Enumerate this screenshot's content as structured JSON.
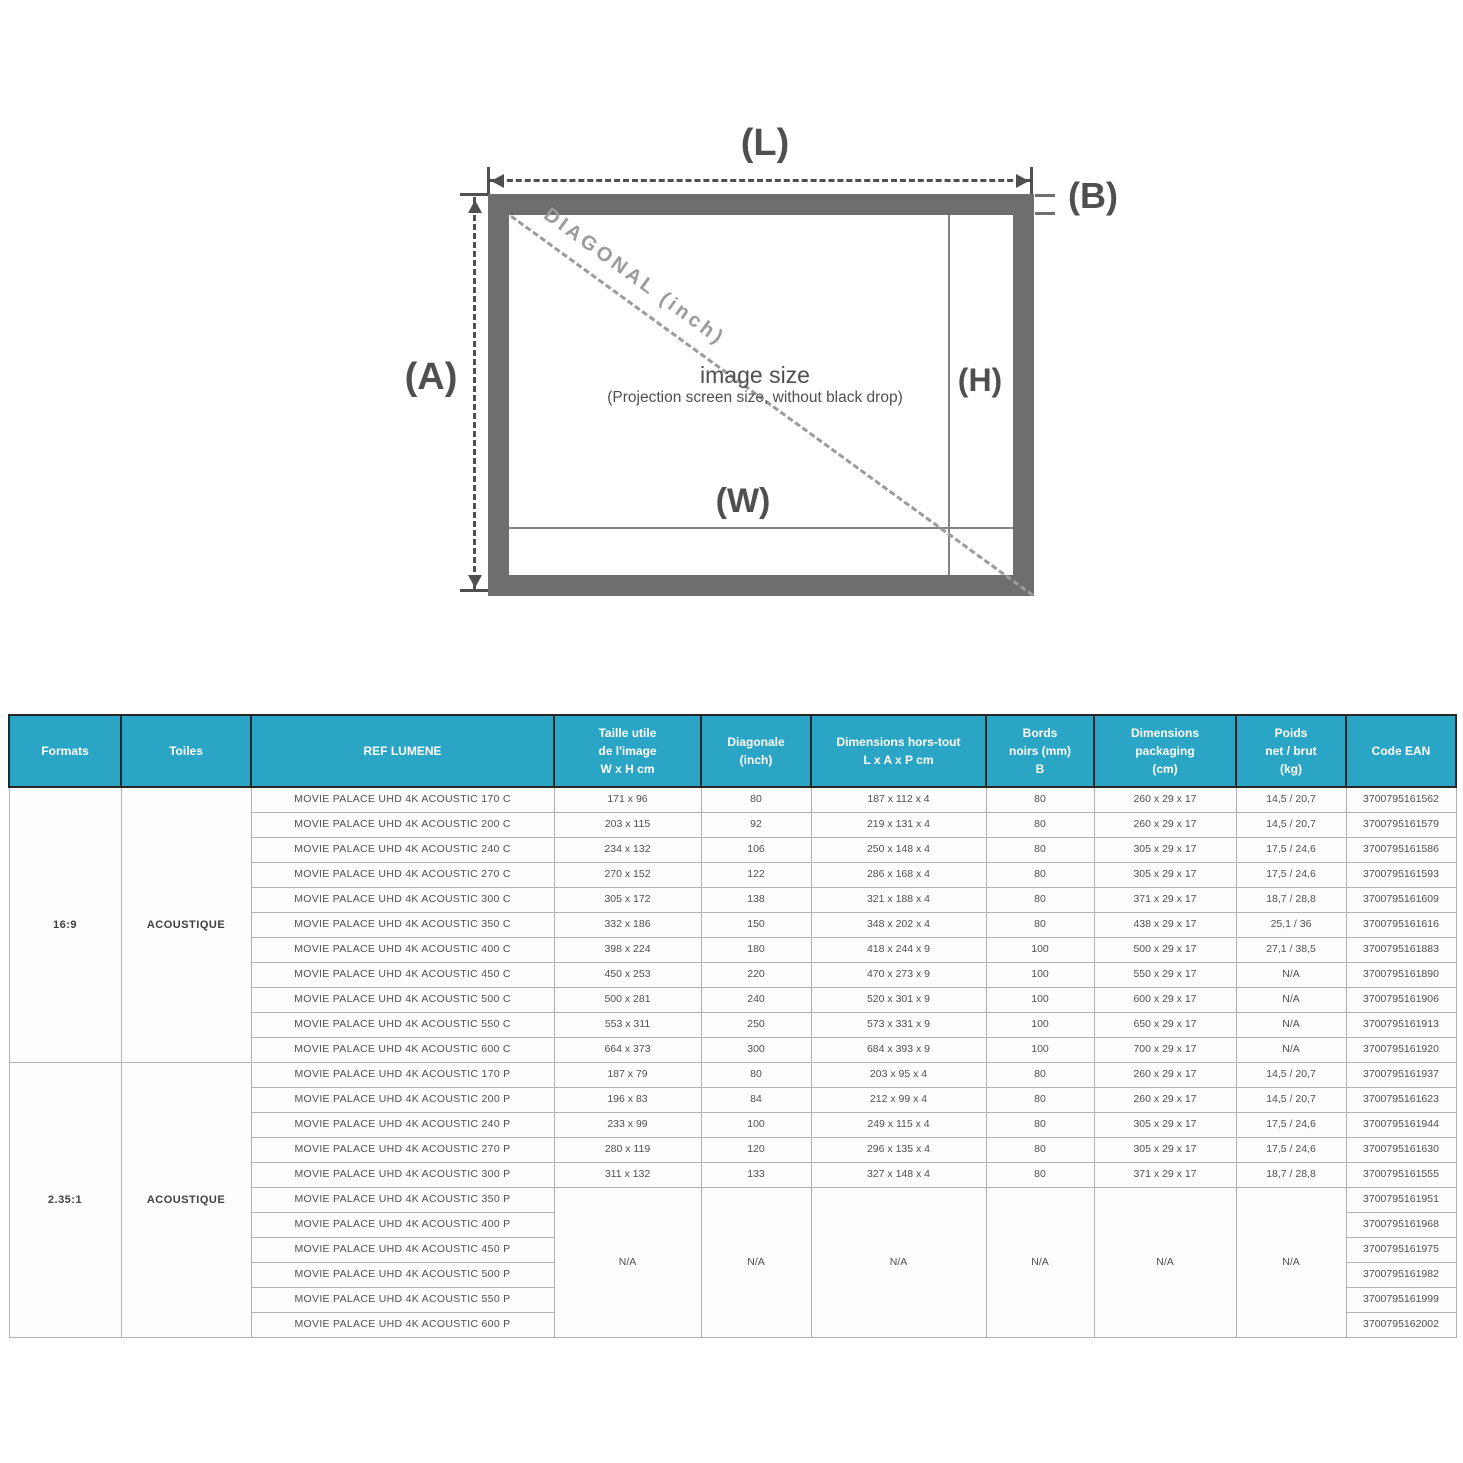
{
  "colors": {
    "accent_teal": "#2aa5c6",
    "frame_gray": "#6e6e6e",
    "dim_line": "#4f4f4f",
    "diagonal_gray": "#9b9b9b"
  },
  "diagram": {
    "label_L": "(L)",
    "label_B": "(B)",
    "label_A": "(A)",
    "label_H": "(H)",
    "label_W": "(W)",
    "diagonal_label": "DIAGONAL (inch)",
    "image_size_title": "image size",
    "image_size_subtitle": "(Projection screen size, without black drop)"
  },
  "table": {
    "headers": [
      "Formats",
      "Toiles",
      "REF LUMENE",
      "Taille utile\nde l'image\nW x H cm",
      "Diagonale\n(inch)",
      "Dimensions hors-tout\nL x A x P cm",
      "Bords\nnoirs (mm)\nB",
      "Dimensions\npackaging\n(cm)",
      "Poids\nnet / brut\n(kg)",
      "Code EAN"
    ],
    "sections": [
      {
        "format": "16:9",
        "toile": "ACOUSTIQUE",
        "rows": [
          {
            "ref": "MOVIE PALACE UHD 4K ACOUSTIC 170 C",
            "taille": "171 x 96",
            "diagonale": "80",
            "hors_tout": "187 x 112 x 4",
            "bords": "80",
            "packaging": "260 x 29 x 17",
            "poids": "14,5 / 20,7",
            "ean": "3700795161562"
          },
          {
            "ref": "MOVIE PALACE UHD 4K ACOUSTIC 200 C",
            "taille": "203 x 115",
            "diagonale": "92",
            "hors_tout": "219 x 131 x 4",
            "bords": "80",
            "packaging": "260 x 29 x 17",
            "poids": "14,5 / 20,7",
            "ean": "3700795161579"
          },
          {
            "ref": "MOVIE PALACE UHD 4K ACOUSTIC 240 C",
            "taille": "234 x 132",
            "diagonale": "106",
            "hors_tout": "250 x 148 x 4",
            "bords": "80",
            "packaging": "305 x 29 x 17",
            "poids": "17,5 / 24,6",
            "ean": "3700795161586"
          },
          {
            "ref": "MOVIE PALACE UHD 4K ACOUSTIC 270 C",
            "taille": "270 x 152",
            "diagonale": "122",
            "hors_tout": "286 x 168 x 4",
            "bords": "80",
            "packaging": "305 x 29 x 17",
            "poids": "17,5 / 24,6",
            "ean": "3700795161593"
          },
          {
            "ref": "MOVIE PALACE UHD 4K ACOUSTIC 300 C",
            "taille": "305 x 172",
            "diagonale": "138",
            "hors_tout": "321 x 188 x 4",
            "bords": "80",
            "packaging": "371 x 29 x 17",
            "poids": "18,7 / 28,8",
            "ean": "3700795161609"
          },
          {
            "ref": "MOVIE PALACE UHD 4K ACOUSTIC 350 C",
            "taille": "332 x 186",
            "diagonale": "150",
            "hors_tout": "348 x 202 x 4",
            "bords": "80",
            "packaging": "438 x 29 x 17",
            "poids": "25,1 / 36",
            "ean": "3700795161616"
          },
          {
            "ref": "MOVIE PALACE UHD 4K ACOUSTIC 400 C",
            "taille": "398 x 224",
            "diagonale": "180",
            "hors_tout": "418 x 244 x 9",
            "bords": "100",
            "packaging": "500 x 29 x 17",
            "poids": "27,1 / 38,5",
            "ean": "3700795161883"
          },
          {
            "ref": "MOVIE PALACE UHD 4K ACOUSTIC 450 C",
            "taille": "450 x 253",
            "diagonale": "220",
            "hors_tout": "470 x 273 x 9",
            "bords": "100",
            "packaging": "550 x 29 x 17",
            "poids": "N/A",
            "ean": "3700795161890"
          },
          {
            "ref": "MOVIE PALACE UHD 4K ACOUSTIC 500 C",
            "taille": "500 x 281",
            "diagonale": "240",
            "hors_tout": "520 x 301 x 9",
            "bords": "100",
            "packaging": "600 x 29 x 17",
            "poids": "N/A",
            "ean": "3700795161906"
          },
          {
            "ref": "MOVIE PALACE UHD 4K ACOUSTIC 550 C",
            "taille": "553 x 311",
            "diagonale": "250",
            "hors_tout": "573 x 331 x 9",
            "bords": "100",
            "packaging": "650 x 29 x 17",
            "poids": "N/A",
            "ean": "3700795161913"
          },
          {
            "ref": "MOVIE PALACE UHD 4K ACOUSTIC 600 C",
            "taille": "664 x 373",
            "diagonale": "300",
            "hors_tout": "684 x 393 x 9",
            "bords": "100",
            "packaging": "700 x 29 x 17",
            "poids": "N/A",
            "ean": "3700795161920"
          }
        ]
      },
      {
        "format": "2.35:1",
        "toile": "ACOUSTIQUE",
        "rows": [
          {
            "ref": "MOVIE PALACE UHD 4K ACOUSTIC 170 P",
            "taille": "187 x 79",
            "diagonale": "80",
            "hors_tout": "203 x 95 x 4",
            "bords": "80",
            "packaging": "260 x 29 x 17",
            "poids": "14,5 / 20,7",
            "ean": "3700795161937"
          },
          {
            "ref": "MOVIE PALACE UHD 4K ACOUSTIC 200 P",
            "taille": "196 x 83",
            "diagonale": "84",
            "hors_tout": "212 x 99 x 4",
            "bords": "80",
            "packaging": "260 x 29 x 17",
            "poids": "14,5 / 20,7",
            "ean": "3700795161623"
          },
          {
            "ref": "MOVIE PALACE UHD 4K ACOUSTIC 240 P",
            "taille": "233 x 99",
            "diagonale": "100",
            "hors_tout": "249 x 115 x 4",
            "bords": "80",
            "packaging": "305 x 29 x 17",
            "poids": "17,5 / 24,6",
            "ean": "3700795161944"
          },
          {
            "ref": "MOVIE PALACE UHD 4K ACOUSTIC 270 P",
            "taille": "280 x 119",
            "diagonale": "120",
            "hors_tout": "296 x 135 x 4",
            "bords": "80",
            "packaging": "305 x 29 x 17",
            "poids": "17,5 / 24,6",
            "ean": "3700795161630"
          },
          {
            "ref": "MOVIE PALACE UHD 4K ACOUSTIC 300 P",
            "taille": "311 x 132",
            "diagonale": "133",
            "hors_tout": "327 x 148 x 4",
            "bords": "80",
            "packaging": "371 x 29 x 17",
            "poids": "18,7 / 28,8",
            "ean": "3700795161555"
          }
        ],
        "na_block": {
          "value": "N/A",
          "refs": [
            "MOVIE PALACE UHD 4K ACOUSTIC 350 P",
            "MOVIE PALACE UHD 4K ACOUSTIC 400 P",
            "MOVIE PALACE UHD 4K ACOUSTIC 450 P",
            "MOVIE PALACE UHD 4K ACOUSTIC 500 P",
            "MOVIE PALACE UHD 4K ACOUSTIC 550 P",
            "MOVIE PALACE UHD 4K ACOUSTIC 600 P"
          ],
          "eans": [
            "3700795161951",
            "3700795161968",
            "3700795161975",
            "3700795161982",
            "3700795161999",
            "3700795162002"
          ]
        }
      }
    ]
  }
}
